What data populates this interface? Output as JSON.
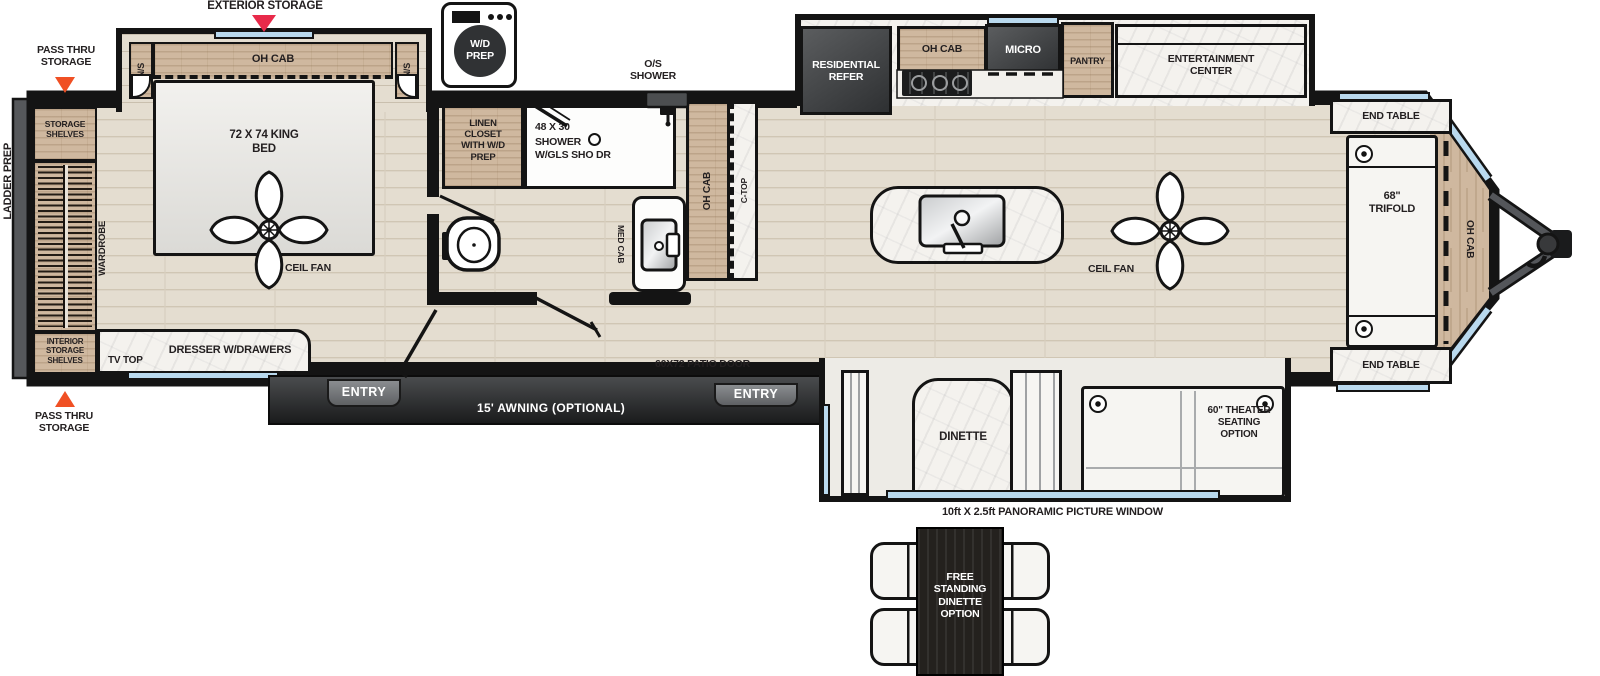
{
  "colors": {
    "wall": "#141414",
    "floor": "#e4ddd0",
    "cabinet_wood": "#cfb89f",
    "marble_white": "#f4f2ee",
    "appliance_dark": "#36383a",
    "window_blue": "#b9d9ee",
    "arrow_red": "#e82a4a",
    "arrow_orange": "#f05024",
    "text": "#231f20"
  },
  "exterior": {
    "exterior_storage": "EXTERIOR STORAGE",
    "pass_thru_storage_top": "PASS THRU STORAGE",
    "pass_thru_storage_bottom": "PASS THRU STORAGE",
    "ladder_prep": "LADDER PREP",
    "awning": "15' AWNING (OPTIONAL)",
    "entry_rear": "ENTRY",
    "entry_front": "ENTRY",
    "patio_door": "60X72 PATIO DOOR",
    "panoramic_window": "10ft X 2.5ft PANORAMIC PICTURE WINDOW"
  },
  "bedroom": {
    "overhead_cabinet": "OH CAB",
    "nightstand_left": "N/S",
    "nightstand_right": "N/S",
    "king_bed": "72 X 74 KING BED",
    "ceiling_fan": "CEIL FAN",
    "wardrobe": "WARDROBE",
    "storage_shelves": "STORAGE SHELVES",
    "interior_storage_shelves": "INTERIOR STORAGE SHELVES",
    "dresser": "DRESSER W/DRAWERS",
    "tv_top": "TV TOP"
  },
  "bathroom": {
    "washer_dryer_prep": "W/D PREP",
    "linen_closet": "LINEN CLOSET WITH W/D PREP",
    "shower_size": "48 X 30",
    "shower": "SHOWER",
    "shower_door": "W/GLS SHO DR",
    "outside_shower": "O/S SHOWER",
    "medicine_cabinet": "MED CAB",
    "overhead_cabinet": "OH CAB",
    "countertop": "C-TOP"
  },
  "kitchen": {
    "refrigerator": "RESIDENTIAL REFER",
    "overhead_cabinet": "OH CAB",
    "microwave": "MICRO",
    "pantry": "PANTRY",
    "entertainment_center": "ENTERTAINMENT CENTER",
    "ceiling_fan": "CEIL FAN"
  },
  "living_area": {
    "end_table_top": "END TABLE",
    "end_table_bottom": "END TABLE",
    "sofa": "68\" TRIFOLD",
    "overhead_cabinet_front": "OH CAB",
    "dinette": "DINETTE",
    "theater_seating": "60\" THEATER SEATING OPTION",
    "free_standing_dinette": "FREE STANDING DINETTE OPTION"
  }
}
